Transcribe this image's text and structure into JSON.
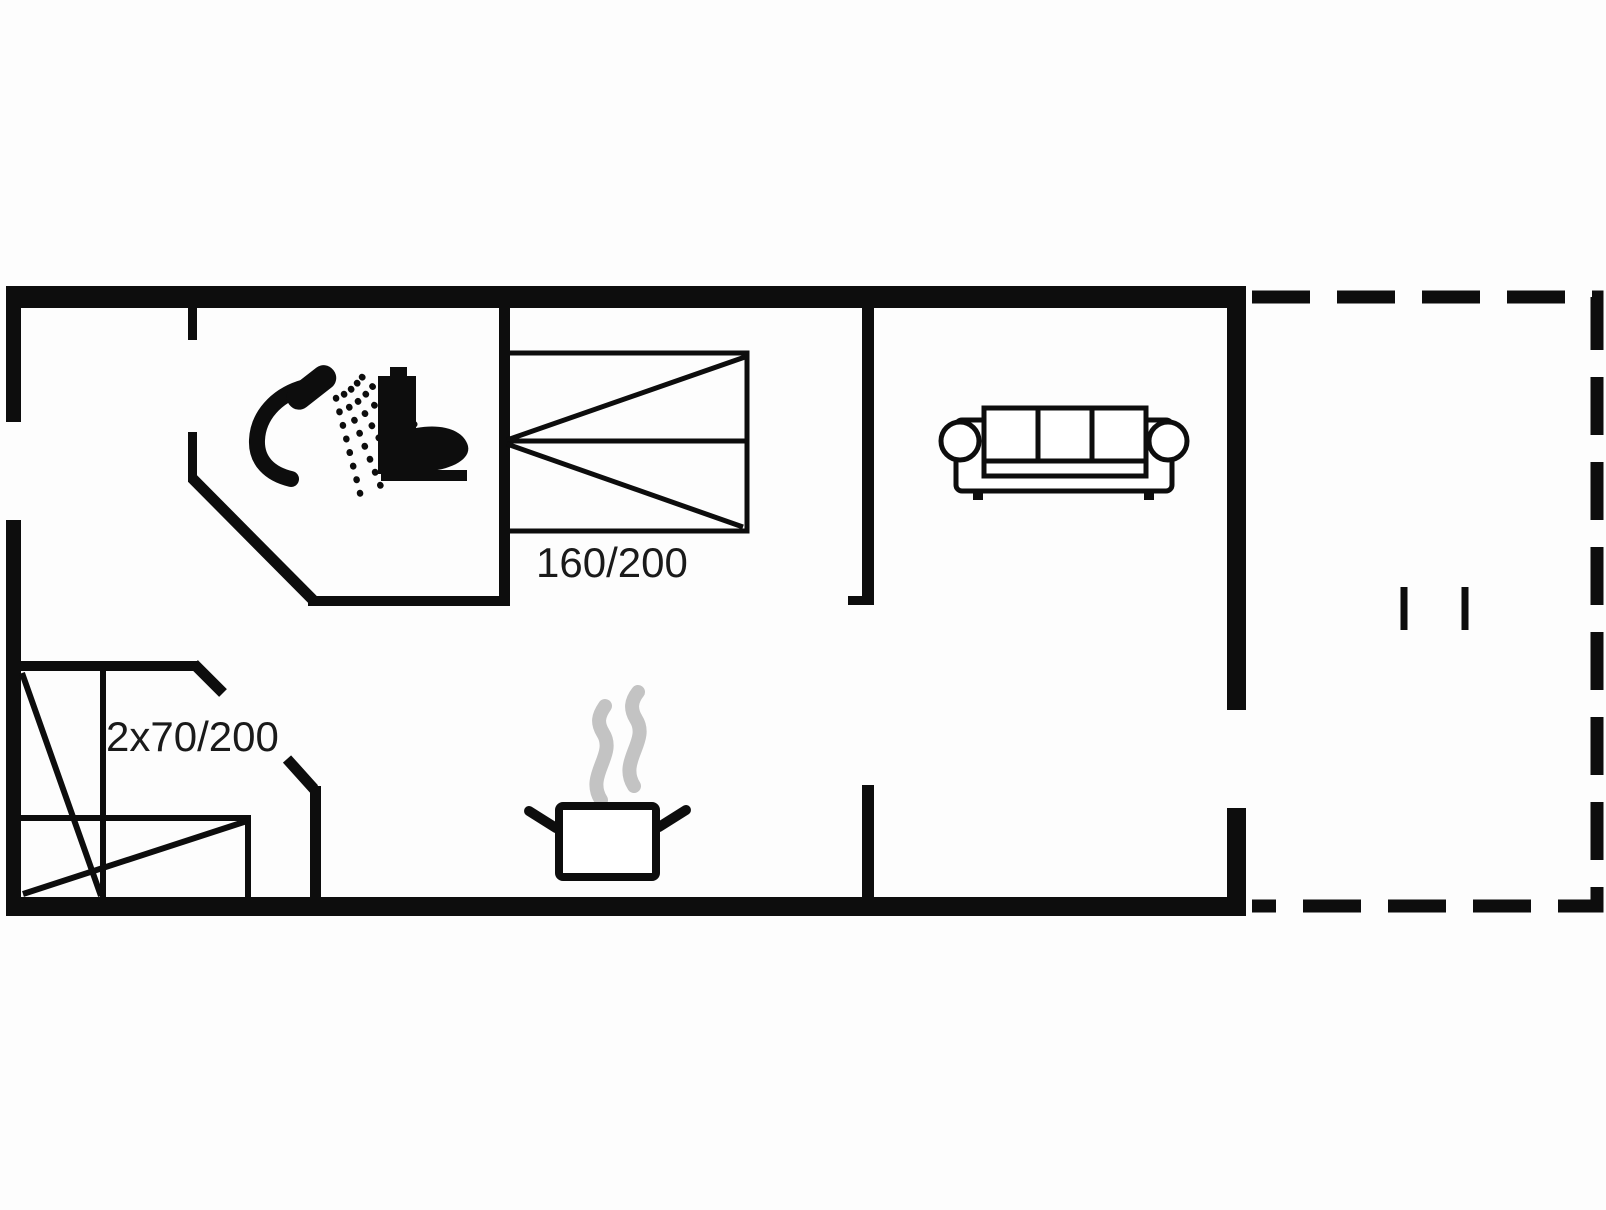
{
  "floor_plan": {
    "type": "vacation-house-floor-plan",
    "colors": {
      "background": "#fdfdfd",
      "wall": "#0d0d0d",
      "steam": "#c3c3c3",
      "text": "#1a1a1a"
    },
    "labels": {
      "double_bed": "160/200",
      "bunk_beds": "2x70/200"
    },
    "rooms": {
      "bathroom": {
        "icons": [
          "shower-icon",
          "toilet-icon"
        ]
      },
      "bedroom": {
        "furniture": [
          "double-bed"
        ],
        "size_label": "160/200"
      },
      "bunk_room": {
        "furniture": [
          "bunk-bed-tall",
          "bunk-bed-low"
        ],
        "size_label": "2x70/200"
      },
      "kitchen_living": {
        "icons": [
          "cooking-pot-icon",
          "sofa-icon"
        ]
      },
      "terrace": {
        "outline_style": "dashed",
        "marks": 2
      }
    }
  }
}
